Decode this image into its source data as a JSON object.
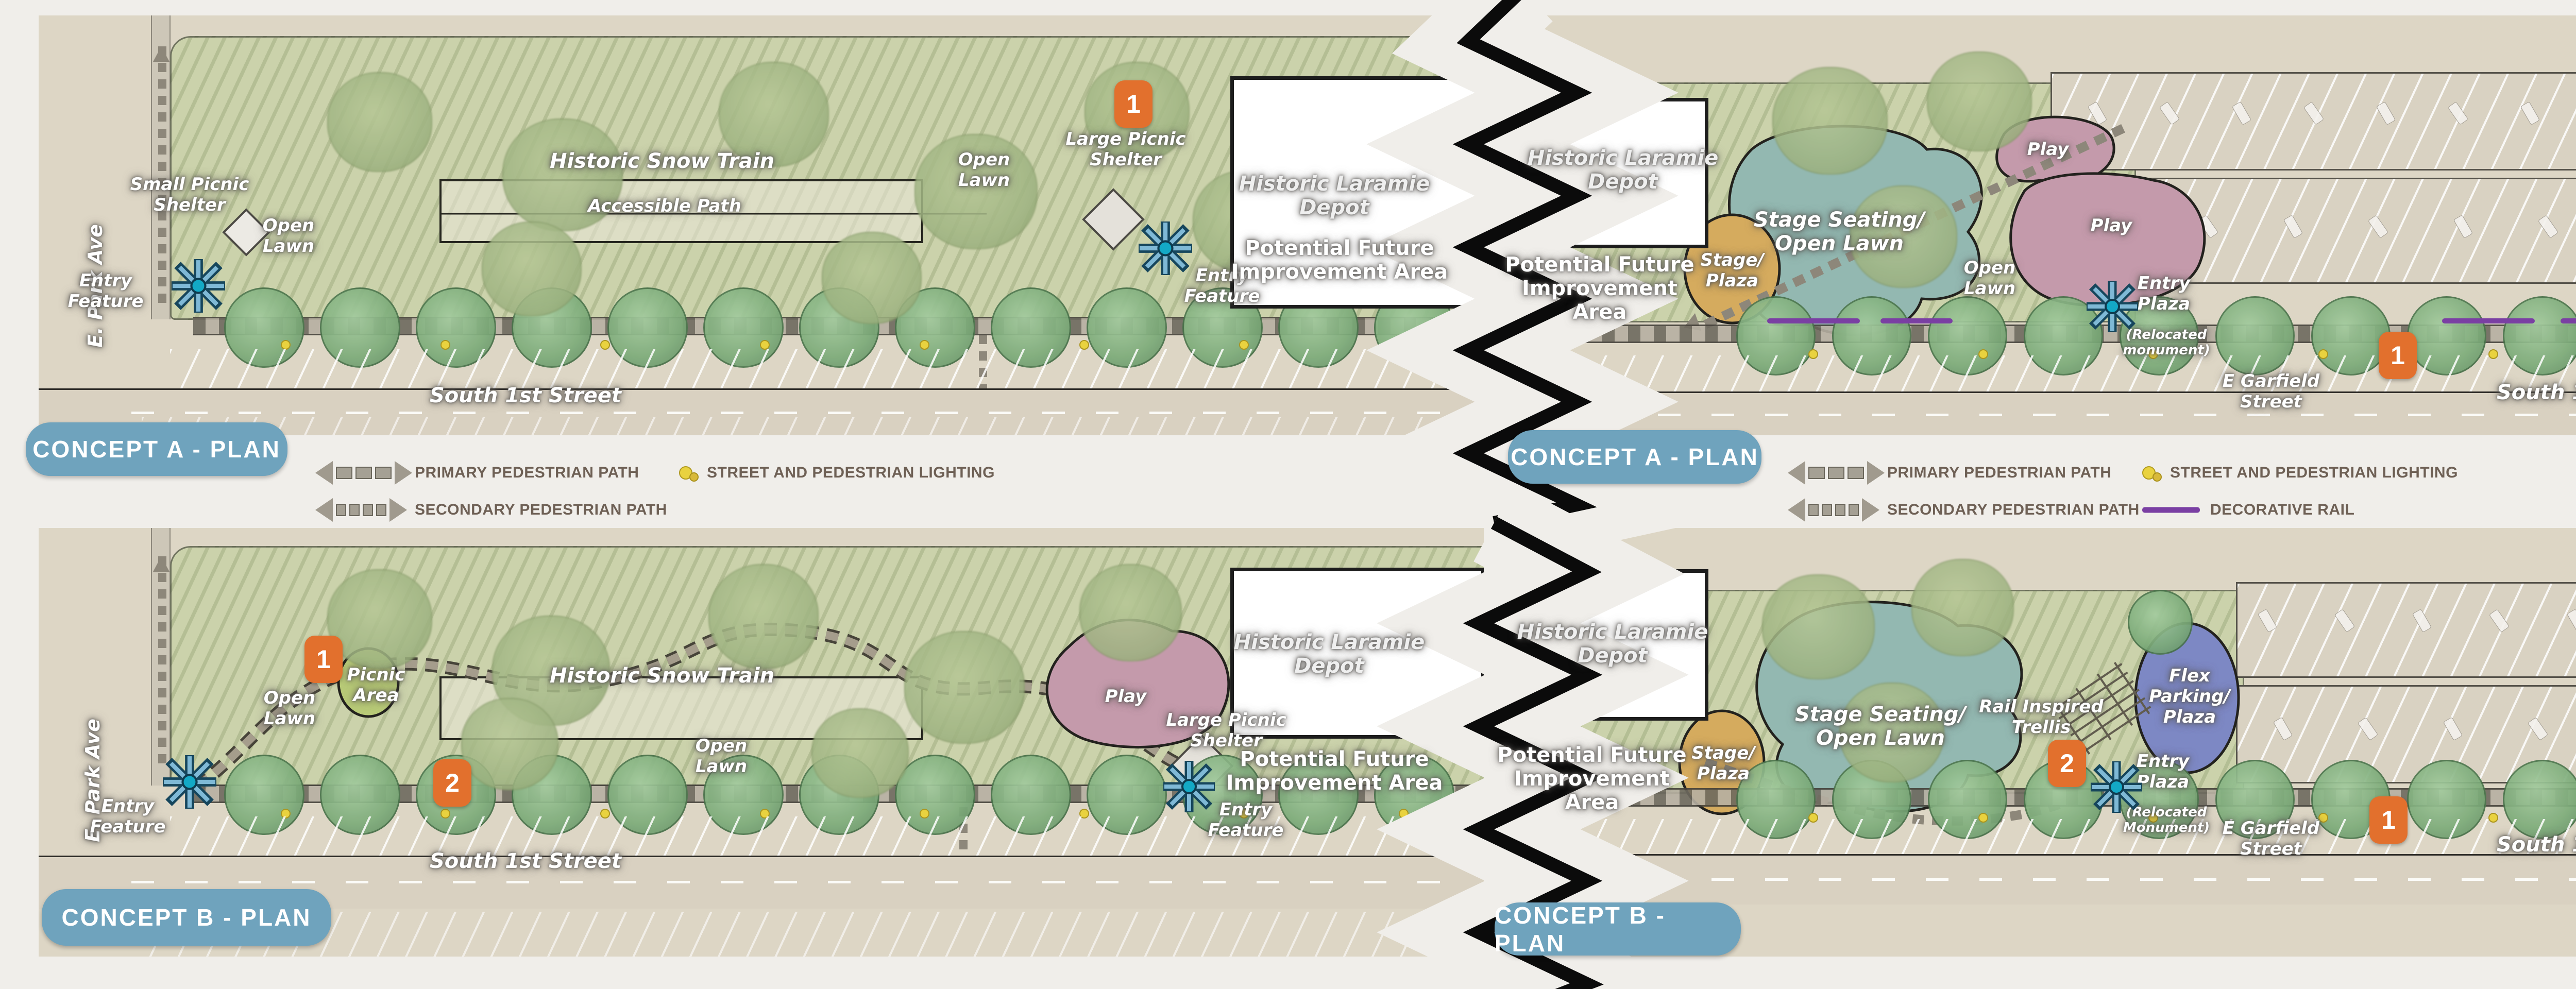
{
  "title": "Laramie Depot Park concept plans",
  "colors": {
    "accent_orange": "#e2702d",
    "concept_badge_blue": "#6fa3bd",
    "decorative_rail_purple": "#7a3fa3",
    "entry_feature_blue": "#1b9dbd",
    "lawn_green": "#cbd2ab",
    "play_pink": "#c49aab",
    "stage_teal": "#93b8b1",
    "stage_gold": "#d5ab5e",
    "flex_blue": "#7d88c4"
  },
  "legends": {
    "left": {
      "concept": "CONCEPT A - PLAN",
      "primary": "PRIMARY PEDESTRIAN PATH",
      "secondary": "SECONDARY PEDESTRIAN PATH",
      "lighting": "STREET AND PEDESTRIAN LIGHTING"
    },
    "right": {
      "concept": "CONCEPT A - PLAN",
      "primary": "PRIMARY PEDESTRIAN PATH",
      "secondary": "SECONDARY PEDESTRIAN PATH",
      "lighting": "STREET AND PEDESTRIAN LIGHTING",
      "rail": "DECORATIVE RAIL"
    }
  },
  "concept_b": {
    "left": "CONCEPT B - PLAN",
    "right": "CONCEPT B - PLAN"
  },
  "north": {
    "label": "NORTH"
  },
  "scale": {
    "ticks": [
      "0",
      "8",
      "16",
      "32"
    ],
    "unit": "FEET"
  },
  "panels": {
    "a_left": {
      "labels": {
        "e_park_ave": "E. Park Ave",
        "small_picnic_shelter": "Small Picnic\nShelter",
        "open_lawn_1": "Open\nLawn",
        "entry_feature_1": "Entry\nFeature",
        "historic_snow_train": "Historic Snow Train",
        "accessible_path": "Accessible Path",
        "open_lawn_2": "Open\nLawn",
        "marker_1": "1",
        "large_picnic_shelter": "Large Picnic\nShelter",
        "entry_feature_2": "Entry\nFeature",
        "depot": "Historic Laramie\nDepot",
        "future_area": "Potential Future\nImprovement Area",
        "south_1st_street": "South 1st Street"
      }
    },
    "a_right": {
      "labels": {
        "depot": "Historic Laramie\nDepot",
        "future_area": "Potential Future\nImprovement\nArea",
        "stage_plaza": "Stage/\nPlaza",
        "stage_seating": "Stage Seating/\nOpen Lawn",
        "open_lawn": "Open\nLawn",
        "play_1": "Play",
        "play_2": "Play",
        "entry_plaza": "Entry\nPlaza",
        "relocated": "(Relocated\nmonument)",
        "marker_1": "1",
        "marker_2": "2",
        "e_garfield_street": "E Garfield\nStreet",
        "south_1st_street": "South 1st Street",
        "e_garfield_vertical": "E Garfield Street"
      }
    },
    "b_left": {
      "labels": {
        "e_park_ave": "E. Park Ave",
        "entry_feature_1": "Entry\nFeature",
        "marker_1": "1",
        "picnic_area": "Picnic\nArea",
        "open_lawn_1": "Open\nLawn",
        "historic_snow_train": "Historic Snow Train",
        "open_lawn_2": "Open\nLawn",
        "play": "Play",
        "large_picnic_shelter": "Large Picnic\nShelter",
        "entry_feature_2": "Entry\nFeature",
        "depot": "Historic Laramie\nDepot",
        "future_area": "Potential Future\nImprovement Area",
        "marker_2": "2",
        "south_1st_street": "South 1st Street"
      }
    },
    "b_right": {
      "labels": {
        "depot": "Historic Laramie\nDepot",
        "future_area": "Potential Future\nImprovement\nArea",
        "stage_plaza": "Stage/\nPlaza",
        "stage_seating": "Stage Seating/\nOpen Lawn",
        "rail_trellis": "Rail Inspired\nTrellis",
        "flex_parking": "Flex\nParking/\nPlaza",
        "marker_2": "2",
        "entry_plaza": "Entry\nPlaza",
        "relocated": "(Relocated\nMonument)",
        "marker_1": "1",
        "e_garfield_street": "E Garfield\nStreet",
        "south_1st_street": "South 1st Street",
        "e_garfield_vertical": "E Garfield Street"
      }
    }
  }
}
